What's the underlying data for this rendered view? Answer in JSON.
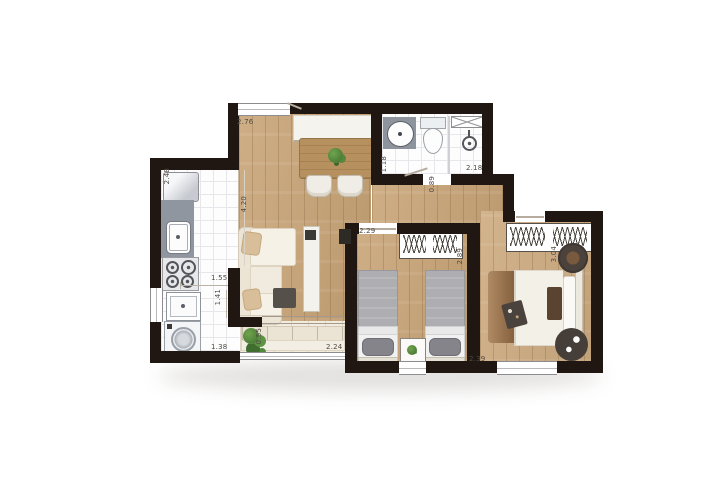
{
  "plan": {
    "type": "residential-apartment-floor-plan",
    "unit": "m",
    "dimensions": [
      {
        "value": "2.76",
        "orientation": "horizontal",
        "location": "living-room-top"
      },
      {
        "value": "2.48",
        "orientation": "vertical",
        "location": "kitchen-fridge-wall"
      },
      {
        "value": "1.18",
        "orientation": "vertical",
        "location": "bathroom-left"
      },
      {
        "value": "2.18",
        "orientation": "horizontal",
        "location": "bathroom-width"
      },
      {
        "value": "0.89",
        "orientation": "vertical",
        "location": "bathroom-door-hall"
      },
      {
        "value": "4.20",
        "orientation": "vertical",
        "location": "living-room-length"
      },
      {
        "value": "2.29",
        "orientation": "horizontal",
        "location": "bedroom-1-width"
      },
      {
        "value": "2.89",
        "orientation": "vertical",
        "location": "bedroom-1-length"
      },
      {
        "value": "3.04",
        "orientation": "vertical",
        "location": "bedroom-2-length"
      },
      {
        "value": "1.55",
        "orientation": "horizontal",
        "location": "kitchen-width"
      },
      {
        "value": "1.41",
        "orientation": "vertical",
        "location": "laundry-depth"
      },
      {
        "value": "0.55",
        "orientation": "vertical",
        "location": "balcony-left"
      },
      {
        "value": "1.38",
        "orientation": "horizontal",
        "location": "laundry-width"
      },
      {
        "value": "2.24",
        "orientation": "horizontal",
        "location": "balcony-width"
      },
      {
        "value": "2.39",
        "orientation": "horizontal",
        "location": "bedroom-2-width"
      }
    ],
    "colors": {
      "wall": "#211712",
      "wood_floor": "#c9a578",
      "tile_floor": "#fdfdfe",
      "balcony_floor": "#f2ecdf",
      "counter_gray": "#8f96a0",
      "plant_green": "#4c7f38",
      "bed_gray": "#aeaeb2",
      "throw_brown": "#a67c52",
      "label_text": "#4f4a43"
    },
    "icons": {
      "fridge-icon": "rounded rect",
      "kitchen-sink-icon": "rounded basin",
      "stove-icon": "four burners",
      "laundry-tank-icon": "square basin",
      "washing-machine-icon": "square with drum",
      "sideboard-icon": "rect",
      "dining-table-icon": "wood rect",
      "dining-chair-icon": "rounded square",
      "plant-icon": "green cluster",
      "sofa-icon": "l-shape sofa",
      "side-table-icon": "dark square",
      "tv-icon": "dark bar",
      "tv-cabinet-icon": "tall rect",
      "bath-sink-icon": "oval basin",
      "toilet-icon": "tank and bowl",
      "shower-icon": "head circle",
      "shower-screen-icon": "x rect",
      "wardrobe-icon": "hanger band",
      "single-bed-icon": "mattress with pillow",
      "double-bed-icon": "mattress throw pillows",
      "nightstand-icon": "square with plant",
      "pouf-icon": "dark circle",
      "bench-icon": "slatted rect"
    }
  }
}
